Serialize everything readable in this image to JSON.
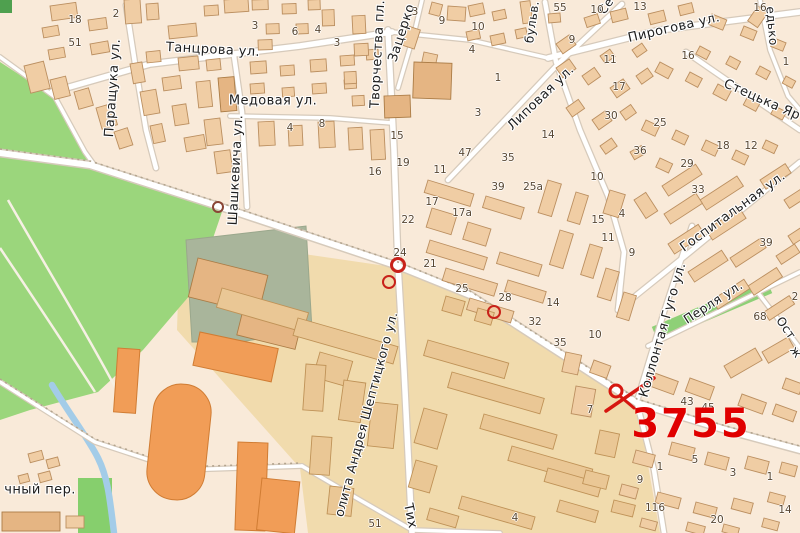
{
  "map": {
    "palette": {
      "background": "#f9ead9",
      "park": "#9bd67c",
      "park_dark": "#4fa04f",
      "water": "#a3cce8",
      "road": "#ffffff",
      "road_casing": "#d6cabb",
      "campus_area": "#f1dbad",
      "building": "#f0cda4",
      "building_outline": "#bb8f60",
      "orange_building": "#f19d57",
      "grey_block": "#a9b59b",
      "accent_red": "#e00000",
      "marker_red": "#c8221a",
      "marker_maroon": "#8a4536",
      "label_color": "#1d1d1d",
      "number_color": "#584733"
    },
    "street_labels": [
      {
        "text": "Танцрова ул.",
        "x": 213,
        "y": 50,
        "rot": 3,
        "size": 13
      },
      {
        "text": "Медовая ул.",
        "x": 273,
        "y": 101,
        "rot": 0,
        "size": 13
      },
      {
        "text": "Паращука ул.",
        "x": 113,
        "y": 88,
        "rot": -86,
        "size": 13
      },
      {
        "text": "Шашкевича ул.",
        "x": 236,
        "y": 170,
        "rot": -87,
        "size": 13
      },
      {
        "text": "Творчества пл.",
        "x": 378,
        "y": 54,
        "rot": -87,
        "size": 13
      },
      {
        "text": "Зацерко",
        "x": 402,
        "y": 33,
        "rot": -72,
        "size": 13
      },
      {
        "text": "Пирогова ул.",
        "x": 674,
        "y": 28,
        "rot": -13,
        "size": 13
      },
      {
        "text": "Липовая ул.",
        "x": 541,
        "y": 98,
        "rot": -44,
        "size": 13
      },
      {
        "text": "Стецька Яр",
        "x": 762,
        "y": 100,
        "rot": 24,
        "size": 13
      },
      {
        "text": "Госпитальная ул.",
        "x": 733,
        "y": 212,
        "rot": -36,
        "size": 13
      },
      {
        "text": "Коллонтая Гуго ул.",
        "x": 663,
        "y": 330,
        "rot": -74,
        "size": 13
      },
      {
        "text": "Перля ул.",
        "x": 713,
        "y": 302,
        "rot": -33,
        "size": 12.5
      },
      {
        "text": "Ост",
        "x": 786,
        "y": 328,
        "rot": 55,
        "size": 12
      },
      {
        "text": "ж",
        "x": 796,
        "y": 352,
        "rot": 55,
        "size": 12
      },
      {
        "text": "едько",
        "x": 772,
        "y": 26,
        "rot": 85,
        "size": 12
      },
      {
        "text": "Се",
        "x": 606,
        "y": 6,
        "rot": -55,
        "size": 12
      },
      {
        "text": "бульв.",
        "x": 532,
        "y": 22,
        "rot": -82,
        "size": 12
      },
      {
        "text": "чный пер.",
        "x": 40,
        "y": 490,
        "rot": 0,
        "size": 13
      },
      {
        "text": "Тих",
        "x": 410,
        "y": 516,
        "rot": 78,
        "size": 13
      },
      {
        "text": "олита Андрея Шептицкого ул.",
        "x": 366,
        "y": 414,
        "rot": -75,
        "size": 12.5
      }
    ],
    "house_numbers": [
      {
        "t": "18",
        "x": 75,
        "y": 20
      },
      {
        "t": "51",
        "x": 75,
        "y": 43
      },
      {
        "t": "2",
        "x": 116,
        "y": 14
      },
      {
        "t": "3",
        "x": 255,
        "y": 26
      },
      {
        "t": "6",
        "x": 295,
        "y": 32
      },
      {
        "t": "4",
        "x": 318,
        "y": 30
      },
      {
        "t": "3",
        "x": 337,
        "y": 43
      },
      {
        "t": "3",
        "x": 415,
        "y": 12
      },
      {
        "t": "9",
        "x": 442,
        "y": 21
      },
      {
        "t": "10",
        "x": 478,
        "y": 27
      },
      {
        "t": "4",
        "x": 472,
        "y": 50
      },
      {
        "t": "1",
        "x": 498,
        "y": 78
      },
      {
        "t": "3",
        "x": 478,
        "y": 113
      },
      {
        "t": "8",
        "x": 322,
        "y": 124
      },
      {
        "t": "4",
        "x": 290,
        "y": 128
      },
      {
        "t": "15",
        "x": 397,
        "y": 136
      },
      {
        "t": "19",
        "x": 403,
        "y": 163
      },
      {
        "t": "16",
        "x": 375,
        "y": 172
      },
      {
        "t": "47",
        "x": 465,
        "y": 153
      },
      {
        "t": "35",
        "x": 508,
        "y": 158
      },
      {
        "t": "14",
        "x": 548,
        "y": 135
      },
      {
        "t": "11",
        "x": 440,
        "y": 170
      },
      {
        "t": "17",
        "x": 432,
        "y": 202
      },
      {
        "t": "17a",
        "x": 462,
        "y": 213
      },
      {
        "t": "22",
        "x": 408,
        "y": 220
      },
      {
        "t": "24",
        "x": 400,
        "y": 253
      },
      {
        "t": "21",
        "x": 430,
        "y": 264
      },
      {
        "t": "25",
        "x": 462,
        "y": 289
      },
      {
        "t": "28",
        "x": 505,
        "y": 298
      },
      {
        "t": "14",
        "x": 553,
        "y": 303
      },
      {
        "t": "32",
        "x": 535,
        "y": 322
      },
      {
        "t": "39",
        "x": 498,
        "y": 187
      },
      {
        "t": "25a",
        "x": 533,
        "y": 187
      },
      {
        "t": "10",
        "x": 597,
        "y": 177
      },
      {
        "t": "15",
        "x": 598,
        "y": 220
      },
      {
        "t": "4",
        "x": 622,
        "y": 214
      },
      {
        "t": "11",
        "x": 608,
        "y": 238
      },
      {
        "t": "9",
        "x": 632,
        "y": 253
      },
      {
        "t": "55",
        "x": 560,
        "y": 8
      },
      {
        "t": "10",
        "x": 597,
        "y": 10
      },
      {
        "t": "13",
        "x": 640,
        "y": 7
      },
      {
        "t": "16",
        "x": 760,
        "y": 8
      },
      {
        "t": "9",
        "x": 572,
        "y": 40
      },
      {
        "t": "11",
        "x": 610,
        "y": 60
      },
      {
        "t": "16",
        "x": 688,
        "y": 56
      },
      {
        "t": "17",
        "x": 619,
        "y": 87
      },
      {
        "t": "1",
        "x": 786,
        "y": 62
      },
      {
        "t": "30",
        "x": 611,
        "y": 116
      },
      {
        "t": "25",
        "x": 660,
        "y": 123
      },
      {
        "t": "36",
        "x": 640,
        "y": 151
      },
      {
        "t": "18",
        "x": 723,
        "y": 146
      },
      {
        "t": "12",
        "x": 751,
        "y": 146
      },
      {
        "t": "29",
        "x": 687,
        "y": 164
      },
      {
        "t": "33",
        "x": 698,
        "y": 190
      },
      {
        "t": "39",
        "x": 766,
        "y": 243
      },
      {
        "t": "68",
        "x": 760,
        "y": 317
      },
      {
        "t": "2",
        "x": 795,
        "y": 297
      },
      {
        "t": "10",
        "x": 595,
        "y": 335
      },
      {
        "t": "35",
        "x": 560,
        "y": 343
      },
      {
        "t": "7",
        "x": 590,
        "y": 410
      },
      {
        "t": "43",
        "x": 687,
        "y": 402
      },
      {
        "t": "45",
        "x": 708,
        "y": 408
      },
      {
        "t": "1",
        "x": 660,
        "y": 467
      },
      {
        "t": "5",
        "x": 695,
        "y": 460
      },
      {
        "t": "3",
        "x": 733,
        "y": 473
      },
      {
        "t": "1",
        "x": 770,
        "y": 477
      },
      {
        "t": "9",
        "x": 640,
        "y": 480
      },
      {
        "t": "116",
        "x": 655,
        "y": 508
      },
      {
        "t": "20",
        "x": 717,
        "y": 520
      },
      {
        "t": "14",
        "x": 785,
        "y": 510
      },
      {
        "t": "51",
        "x": 375,
        "y": 524
      },
      {
        "t": "4",
        "x": 515,
        "y": 518
      }
    ],
    "markers": {
      "big_label": {
        "text": "3755",
        "x": 691,
        "y": 424,
        "size": 40,
        "color": "#e00000"
      },
      "rings": [
        {
          "x": 218,
          "y": 207,
          "r": 6,
          "w": 2,
          "color": "#8a4536"
        },
        {
          "x": 398,
          "y": 265,
          "r": 8,
          "w": 3,
          "color": "#c8221a"
        },
        {
          "x": 389,
          "y": 282,
          "r": 7,
          "w": 2.5,
          "color": "#c8221a"
        },
        {
          "x": 494,
          "y": 312,
          "r": 7,
          "w": 2.5,
          "color": "#c8221a"
        }
      ],
      "cross": {
        "color": "#d61710",
        "x": 630,
        "y": 394
      }
    }
  }
}
